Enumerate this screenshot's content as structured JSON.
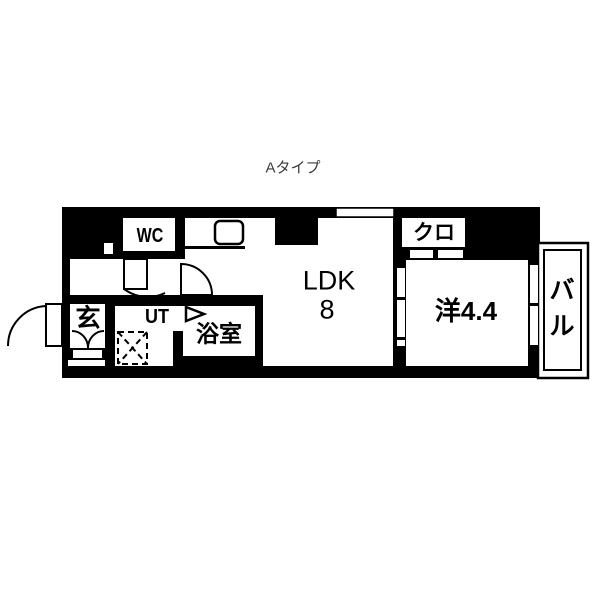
{
  "floor_plan": {
    "unit_type_label": "Aタイプ",
    "rooms": {
      "wc": {
        "label": "WC"
      },
      "ldk": {
        "label": "LDK",
        "size": "8"
      },
      "closet": {
        "label": "クロ"
      },
      "western_room": {
        "label": "洋4.4"
      },
      "balcony": {
        "char_top": "バ",
        "char_bottom": "ル"
      },
      "entrance": {
        "label": "玄"
      },
      "utility": {
        "label": "UT"
      },
      "bathroom": {
        "label": "浴室"
      }
    },
    "colors": {
      "wall": "#000000",
      "floor": "#ffffff",
      "text": "#000000",
      "title": "#3b3b3b"
    }
  }
}
